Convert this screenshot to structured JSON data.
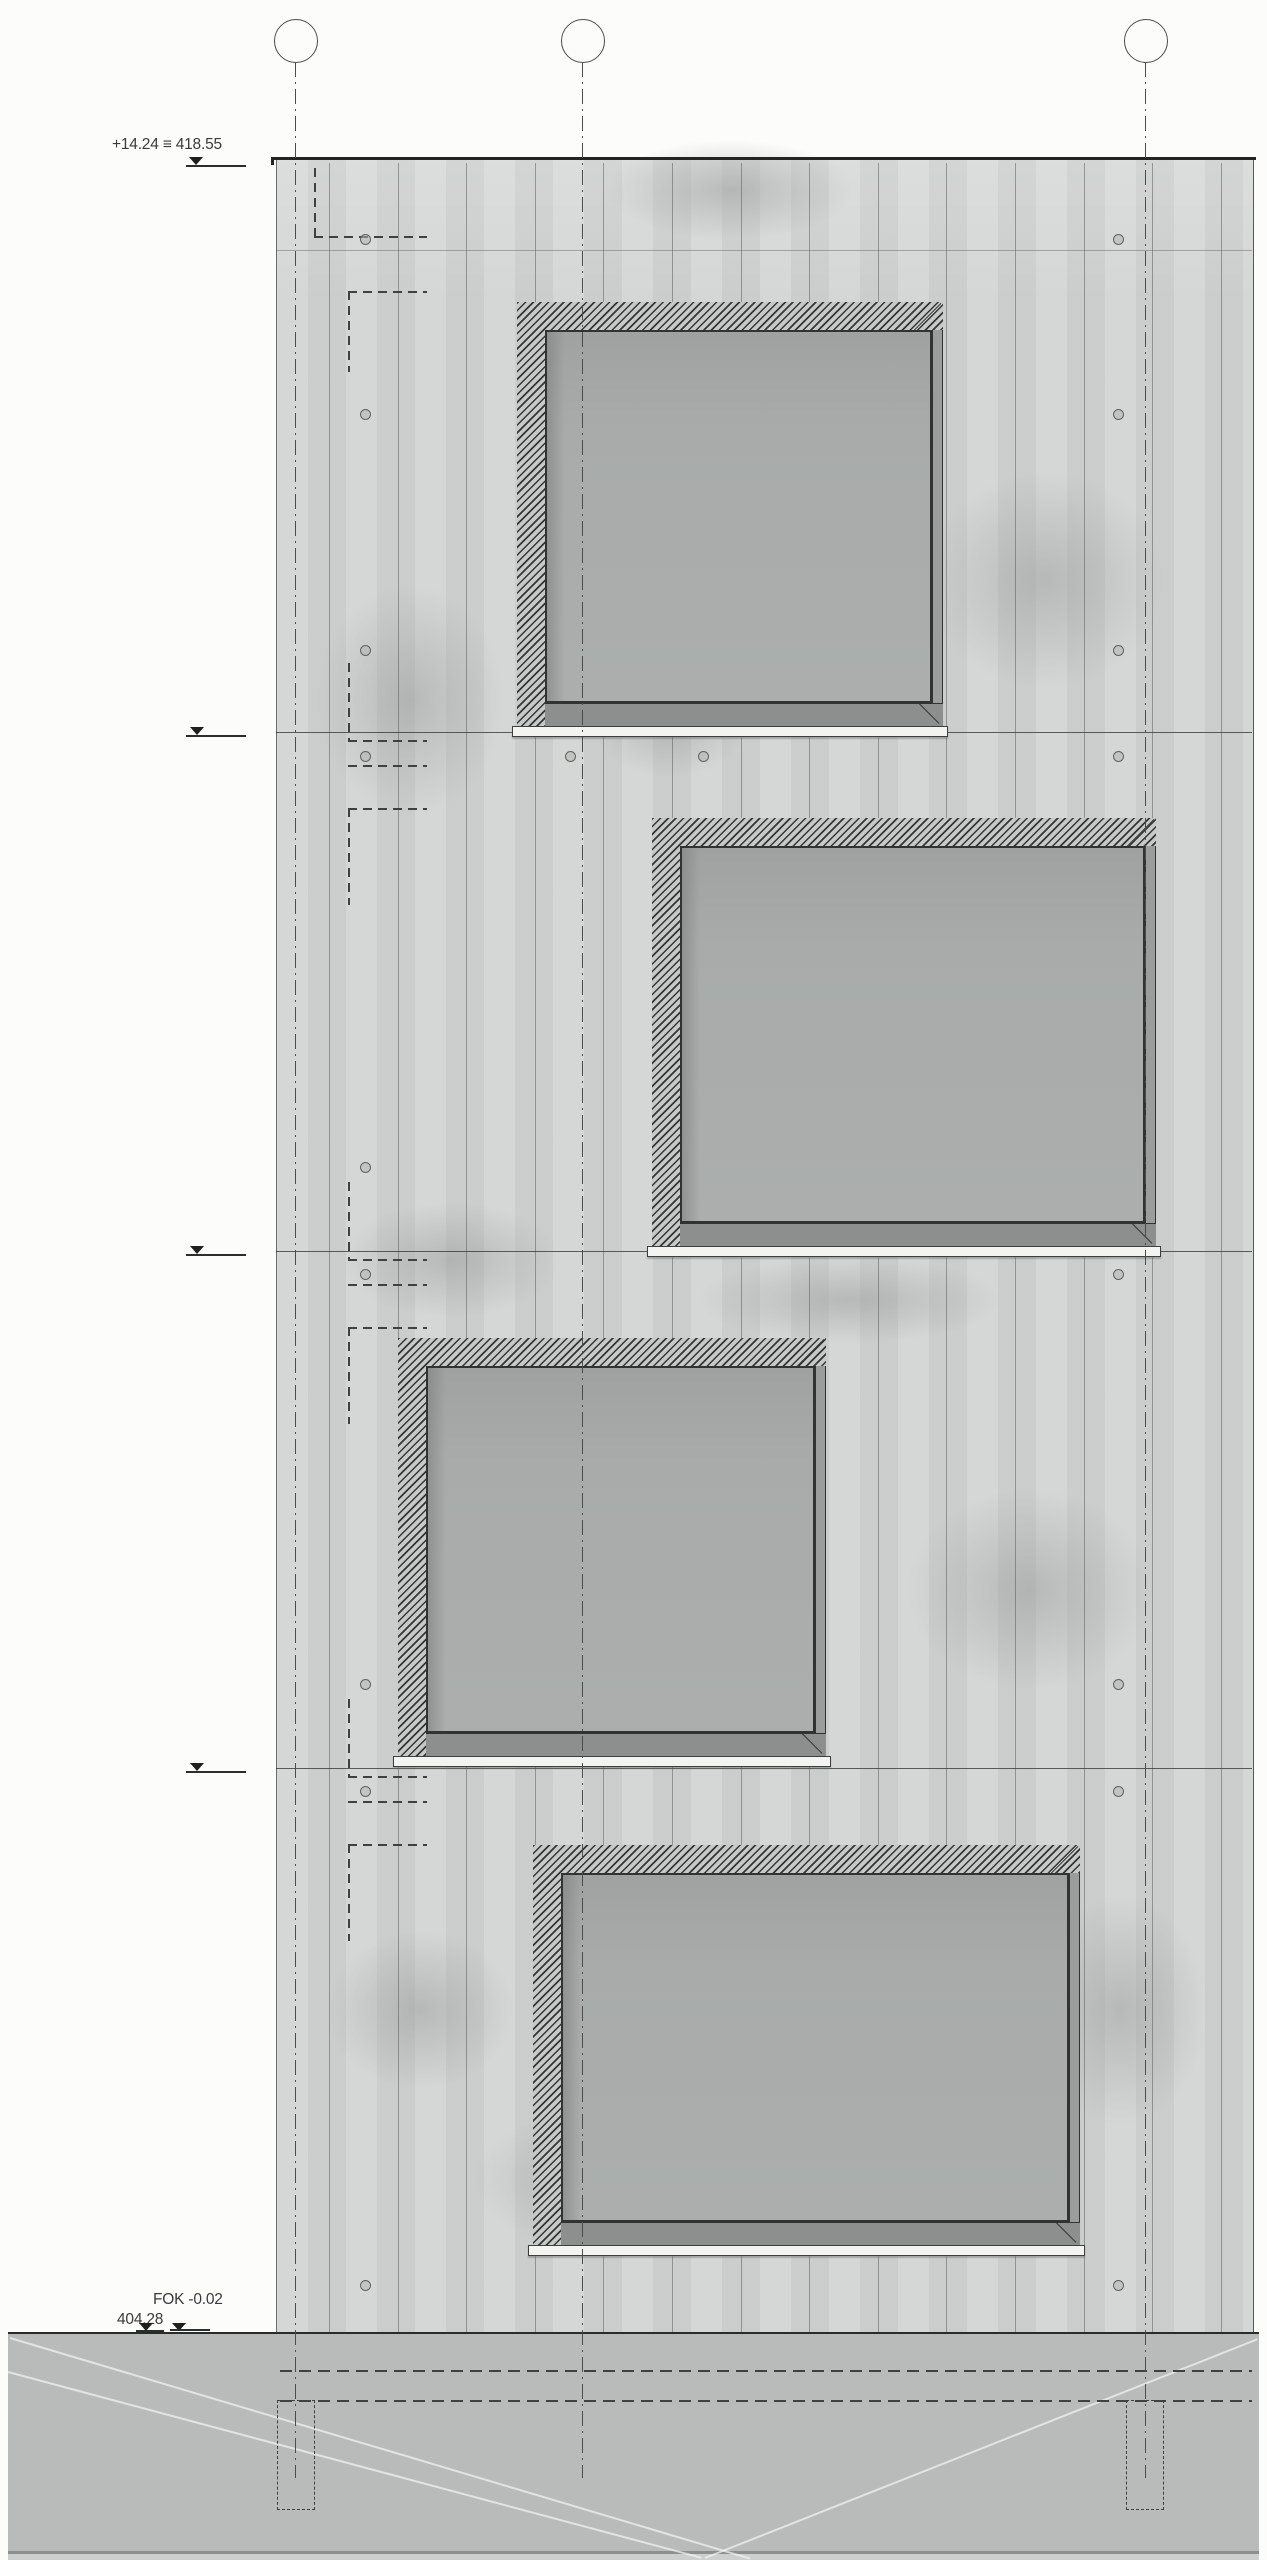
{
  "drawing_type": "building-elevation",
  "colors": {
    "wall": "#d1d3d2",
    "glass": "#aaadac",
    "ground": "#b9bbba",
    "hatch_line": "#343635",
    "text": "#393b3a",
    "ledge": "#f3f3f2"
  },
  "top_annotation": {
    "text": "+14.24 ≡ 418.55"
  },
  "grid_bubbles": [
    {
      "label": "1",
      "x": 295
    },
    {
      "label": "2",
      "x": 582
    },
    {
      "label": "3",
      "x": 1145
    }
  ],
  "grid": {
    "cy": 40,
    "r": 21,
    "line_top": 62,
    "line_bottom": 2478
  },
  "levels": [
    {
      "label": "FOK +10.43",
      "text_x": 143,
      "text_y": 704,
      "line_y": 732
    },
    {
      "label": "FOK +7.03",
      "text_x": 143,
      "text_y": 1223,
      "line_y": 1251
    },
    {
      "label": "FOK +3,63",
      "text_x": 143,
      "text_y": 1740,
      "line_y": 1768
    }
  ],
  "bottom_annotation": {
    "line1": "FOK -0.02",
    "line2": "404,28"
  },
  "wall": {
    "x": 276,
    "y": 160,
    "w": 976,
    "h": 2172,
    "joint_y": 250
  },
  "boards": {
    "x0": 329,
    "step": 68.6,
    "n": 14
  },
  "windows": [
    {
      "x": 517,
      "y": 302,
      "w": 426,
      "h": 424,
      "crosshair": {
        "cx": 700,
        "cy": 516
      }
    },
    {
      "x": 652,
      "y": 818,
      "w": 504,
      "h": 428,
      "double_jamb": true
    },
    {
      "x": 398,
      "y": 1338,
      "w": 428,
      "h": 418,
      "double_jamb": true
    },
    {
      "x": 533,
      "y": 1845,
      "w": 547,
      "h": 400,
      "double_jamb": true
    }
  ],
  "window_bands": {
    "hatch": 28,
    "jamb": 11,
    "sill": 23,
    "ledge_h": 11,
    "ledge_pad": 5
  },
  "dots": [
    [
      364,
      238
    ],
    [
      1117,
      238
    ],
    [
      364,
      413
    ],
    [
      1117,
      413
    ],
    [
      364,
      649
    ],
    [
      1117,
      649
    ],
    [
      364,
      755
    ],
    [
      569,
      755
    ],
    [
      702,
      755
    ],
    [
      1117,
      755
    ],
    [
      364,
      1166
    ],
    [
      364,
      1273
    ],
    [
      1117,
      1273
    ],
    [
      364,
      1683
    ],
    [
      1117,
      1683
    ],
    [
      364,
      1790
    ],
    [
      1117,
      1790
    ],
    [
      364,
      2284
    ],
    [
      1117,
      2284
    ]
  ],
  "dashes": [
    {
      "x": 314,
      "y": 168,
      "len": 68,
      "o": "v"
    },
    {
      "x": 314,
      "y": 236,
      "len": 113,
      "o": "h"
    },
    {
      "x": 348,
      "y": 291,
      "len": 79,
      "o": "h"
    },
    {
      "x": 348,
      "y": 291,
      "len": 81,
      "o": "v"
    },
    {
      "x": 348,
      "y": 663,
      "len": 77,
      "o": "v"
    },
    {
      "x": 348,
      "y": 740,
      "len": 79,
      "o": "h"
    },
    {
      "x": 348,
      "y": 765,
      "len": 79,
      "o": "h"
    },
    {
      "x": 348,
      "y": 808,
      "len": 79,
      "o": "h"
    },
    {
      "x": 348,
      "y": 808,
      "len": 97,
      "o": "v"
    },
    {
      "x": 348,
      "y": 1182,
      "len": 77,
      "o": "v"
    },
    {
      "x": 348,
      "y": 1259,
      "len": 79,
      "o": "h"
    },
    {
      "x": 348,
      "y": 1284,
      "len": 79,
      "o": "h"
    },
    {
      "x": 348,
      "y": 1327,
      "len": 79,
      "o": "h"
    },
    {
      "x": 348,
      "y": 1327,
      "len": 97,
      "o": "v"
    },
    {
      "x": 348,
      "y": 1699,
      "len": 77,
      "o": "v"
    },
    {
      "x": 348,
      "y": 1776,
      "len": 79,
      "o": "h"
    },
    {
      "x": 348,
      "y": 1801,
      "len": 79,
      "o": "h"
    },
    {
      "x": 348,
      "y": 1844,
      "len": 79,
      "o": "h"
    },
    {
      "x": 348,
      "y": 1844,
      "len": 97,
      "o": "v"
    },
    {
      "x": 284,
      "y": 2370,
      "len": 30,
      "o": "v"
    },
    {
      "x": 314,
      "y": 2370,
      "len": 30,
      "o": "v"
    }
  ],
  "underground": {
    "dashed_h": [
      {
        "x": 280,
        "y": 2370,
        "len": 972
      },
      {
        "x": 280,
        "y": 2400,
        "len": 972
      }
    ],
    "piers": [
      {
        "x": 277,
        "y": 2400,
        "w": 38,
        "h": 110
      },
      {
        "x": 1126,
        "y": 2400,
        "w": 38,
        "h": 110
      }
    ]
  },
  "ground_diagonals": [
    {
      "x": 10,
      "y": 2337,
      "len": 772,
      "ang": 16.6
    },
    {
      "x": 8,
      "y": 2371,
      "len": 718,
      "ang": 15.0
    },
    {
      "x": 705,
      "y": 2557,
      "len": 594,
      "ang": -21.6
    }
  ],
  "blotches": [
    {
      "x": 880,
      "y": 430,
      "w": 330,
      "h": 300
    },
    {
      "x": 280,
      "y": 540,
      "w": 260,
      "h": 320
    },
    {
      "x": 560,
      "y": 120,
      "w": 340,
      "h": 140
    },
    {
      "x": 300,
      "y": 1180,
      "w": 300,
      "h": 160
    },
    {
      "x": 640,
      "y": 1240,
      "w": 420,
      "h": 120
    },
    {
      "x": 860,
      "y": 1450,
      "w": 340,
      "h": 280
    },
    {
      "x": 290,
      "y": 1900,
      "w": 260,
      "h": 220
    },
    {
      "x": 420,
      "y": 2080,
      "w": 380,
      "h": 200
    },
    {
      "x": 1000,
      "y": 1850,
      "w": 240,
      "h": 320
    },
    {
      "x": 560,
      "y": 640,
      "w": 220,
      "h": 160
    }
  ]
}
